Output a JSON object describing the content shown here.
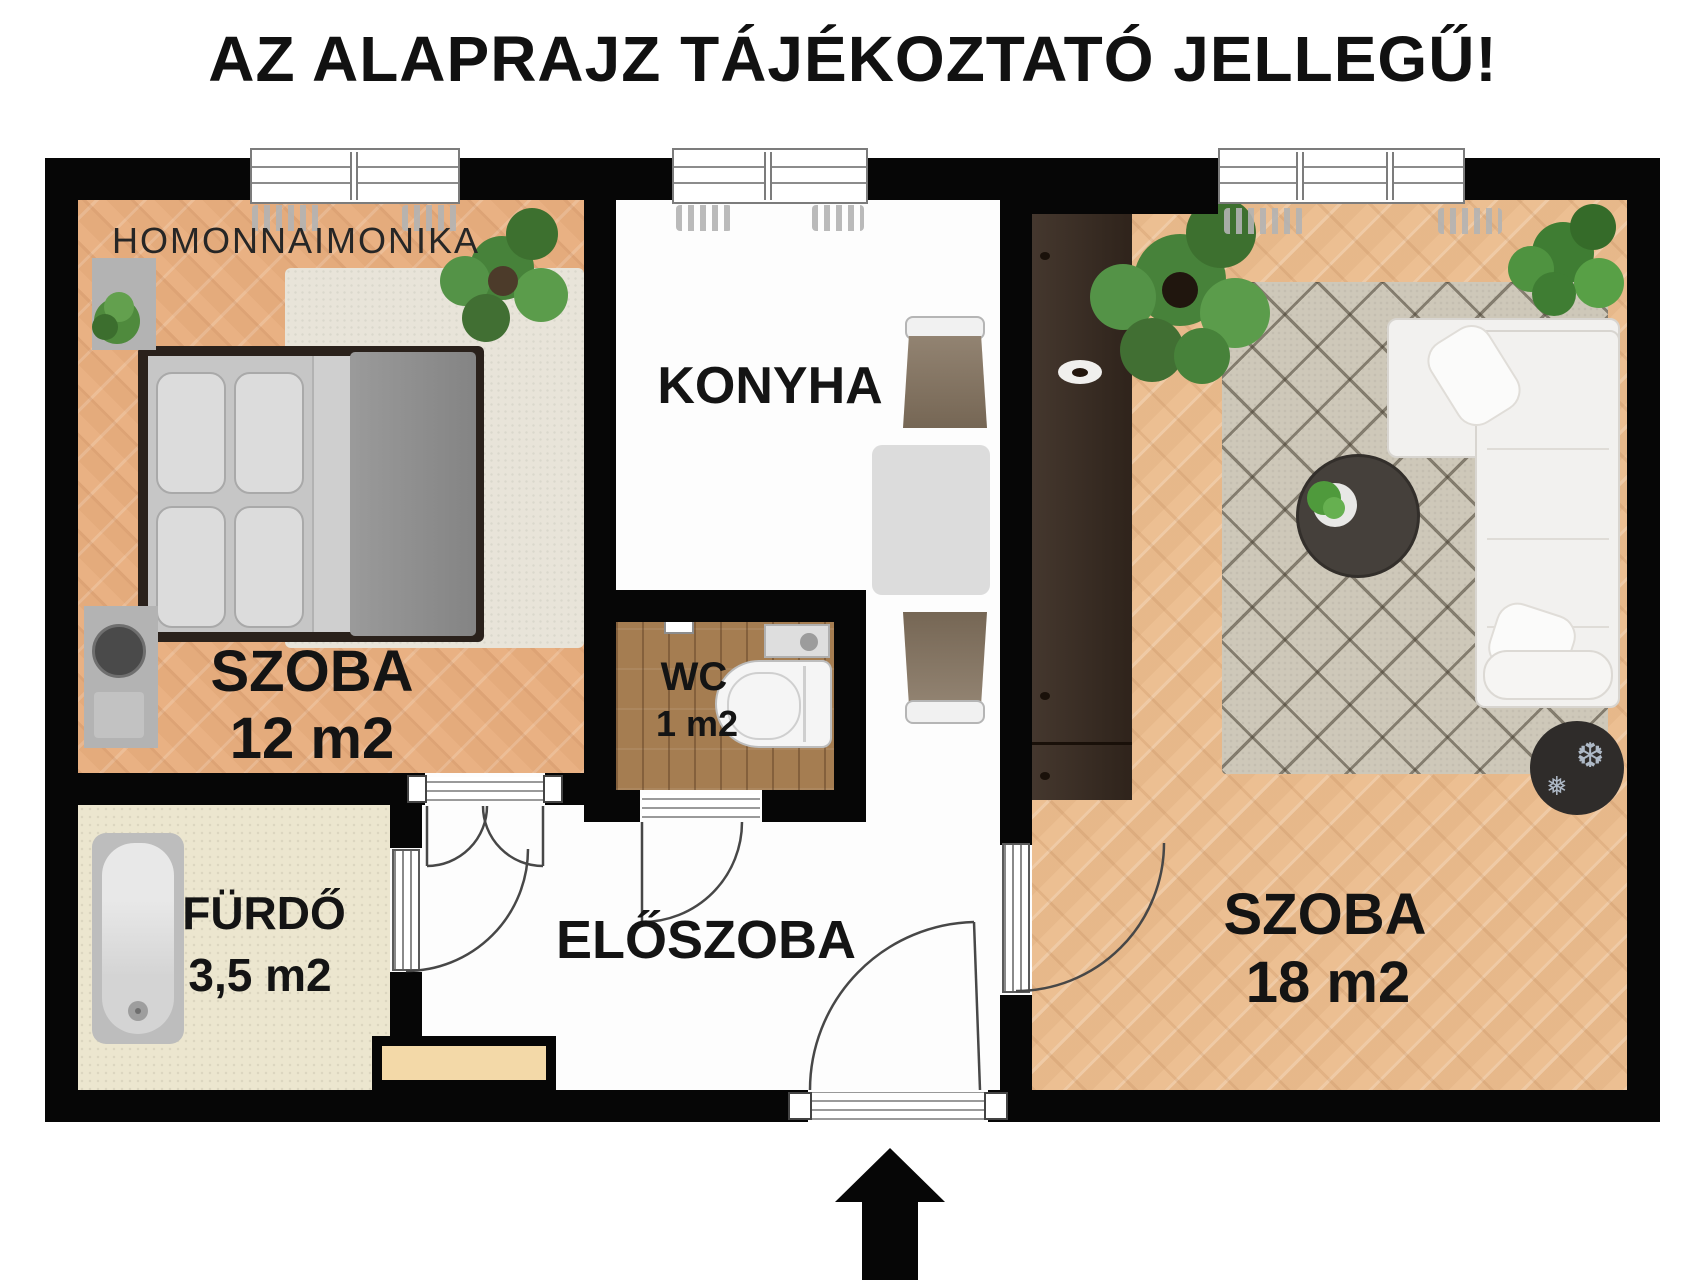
{
  "title": "AZ ALAPRAJZ TÁJÉKOZTATÓ JELLEGŰ!",
  "watermark": "HOMONNAIMONIKA",
  "rooms": {
    "bedroom": {
      "name": "SZOBA",
      "area": "12 m2"
    },
    "kitchen": {
      "name": "KONYHA"
    },
    "wc": {
      "name": "WC",
      "area": "1 m2"
    },
    "bathroom": {
      "name": "FÜRDŐ",
      "area": "3,5 m2"
    },
    "hallway": {
      "name": "ELŐSZOBA"
    },
    "living_room": {
      "name": "SZOBA",
      "area": "18 m2"
    }
  },
  "icons": {
    "snowflake_large": "❆",
    "snowflake_small": "❅"
  },
  "colors": {
    "wall": "#060606",
    "parquet_bedroom": "#e9b183",
    "parquet_living": "#ecbf92",
    "bathroom_floor": "#ece6cf",
    "wc_floor": "#a57d51",
    "bedroom_rug": "#e8e4d9",
    "living_rug": "#cec8b9",
    "wardrobe": "#392b21",
    "cabinet": "#f3d9a8",
    "sofa": "#f2f1ef",
    "plant_green": "#4f8a3d"
  },
  "entrance": {
    "direction": "up"
  }
}
